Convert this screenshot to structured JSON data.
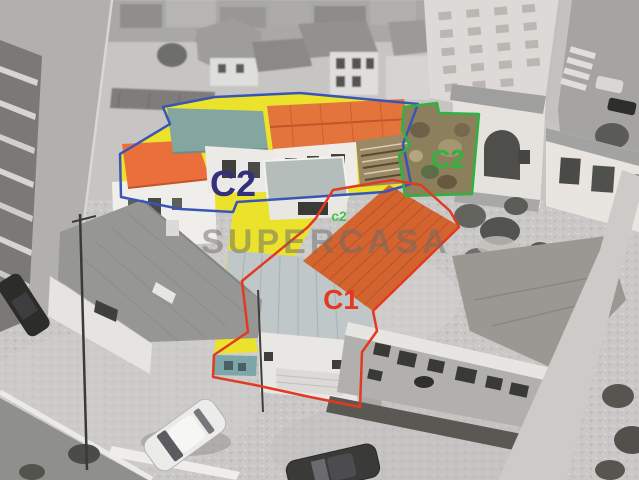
{
  "scene": {
    "photo_type": "aerial",
    "watermark": {
      "text": "SUPERCASA",
      "color": "#6a6a6a"
    }
  },
  "parcels": {
    "c2_main": {
      "label": "C2",
      "outline_color": "#3b55b5",
      "label_color": "#34307c"
    },
    "c2_ruin": {
      "label": "C2",
      "outline_color": "#2fb340",
      "label_color": "#2fb340"
    },
    "c2_marker": {
      "label": "c2",
      "label_color": "#43c24f"
    },
    "c1": {
      "label": "C1",
      "outline_color": "#e23a22",
      "label_color": "#e23a22"
    }
  },
  "highlights": {
    "courtyard_yellow": "#ebe32b",
    "roof_orange_main": "#e2743c",
    "roof_orange_small": "#eb6f3a",
    "roof_orange_c1": "#d4642f",
    "leanto_teal": "#7ca6a8"
  }
}
